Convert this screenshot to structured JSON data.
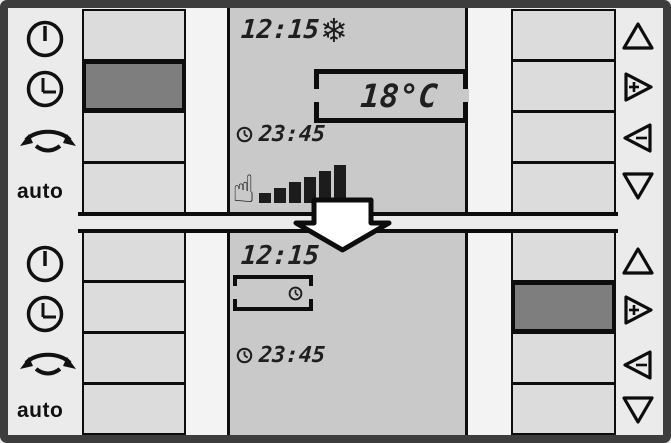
{
  "labels": {
    "auto": "auto"
  },
  "icons": {
    "snowflake": "❄",
    "hand": "☝"
  },
  "colors": {
    "panel_bg": "#ebebeb",
    "display_bg": "#c9c9c9",
    "button_bg": "#dcdcdc",
    "selected_button_bg": "#7e7e7e",
    "lcd_segments": "#1f1f1f",
    "frame": "#3d3d3d"
  },
  "panels": {
    "top": {
      "selected_button": "left-row-2-clock",
      "display": {
        "time": "12:15",
        "mode_icon": "snowflake",
        "setpoint": "18°C",
        "program_time": "23:45",
        "level_bars": [
          10,
          15,
          21,
          26,
          32,
          38
        ]
      }
    },
    "bottom": {
      "selected_button": "right-row-2-plus",
      "display": {
        "time": "12:15",
        "status_box_icon": "clock",
        "program_time": "23:45"
      }
    }
  }
}
